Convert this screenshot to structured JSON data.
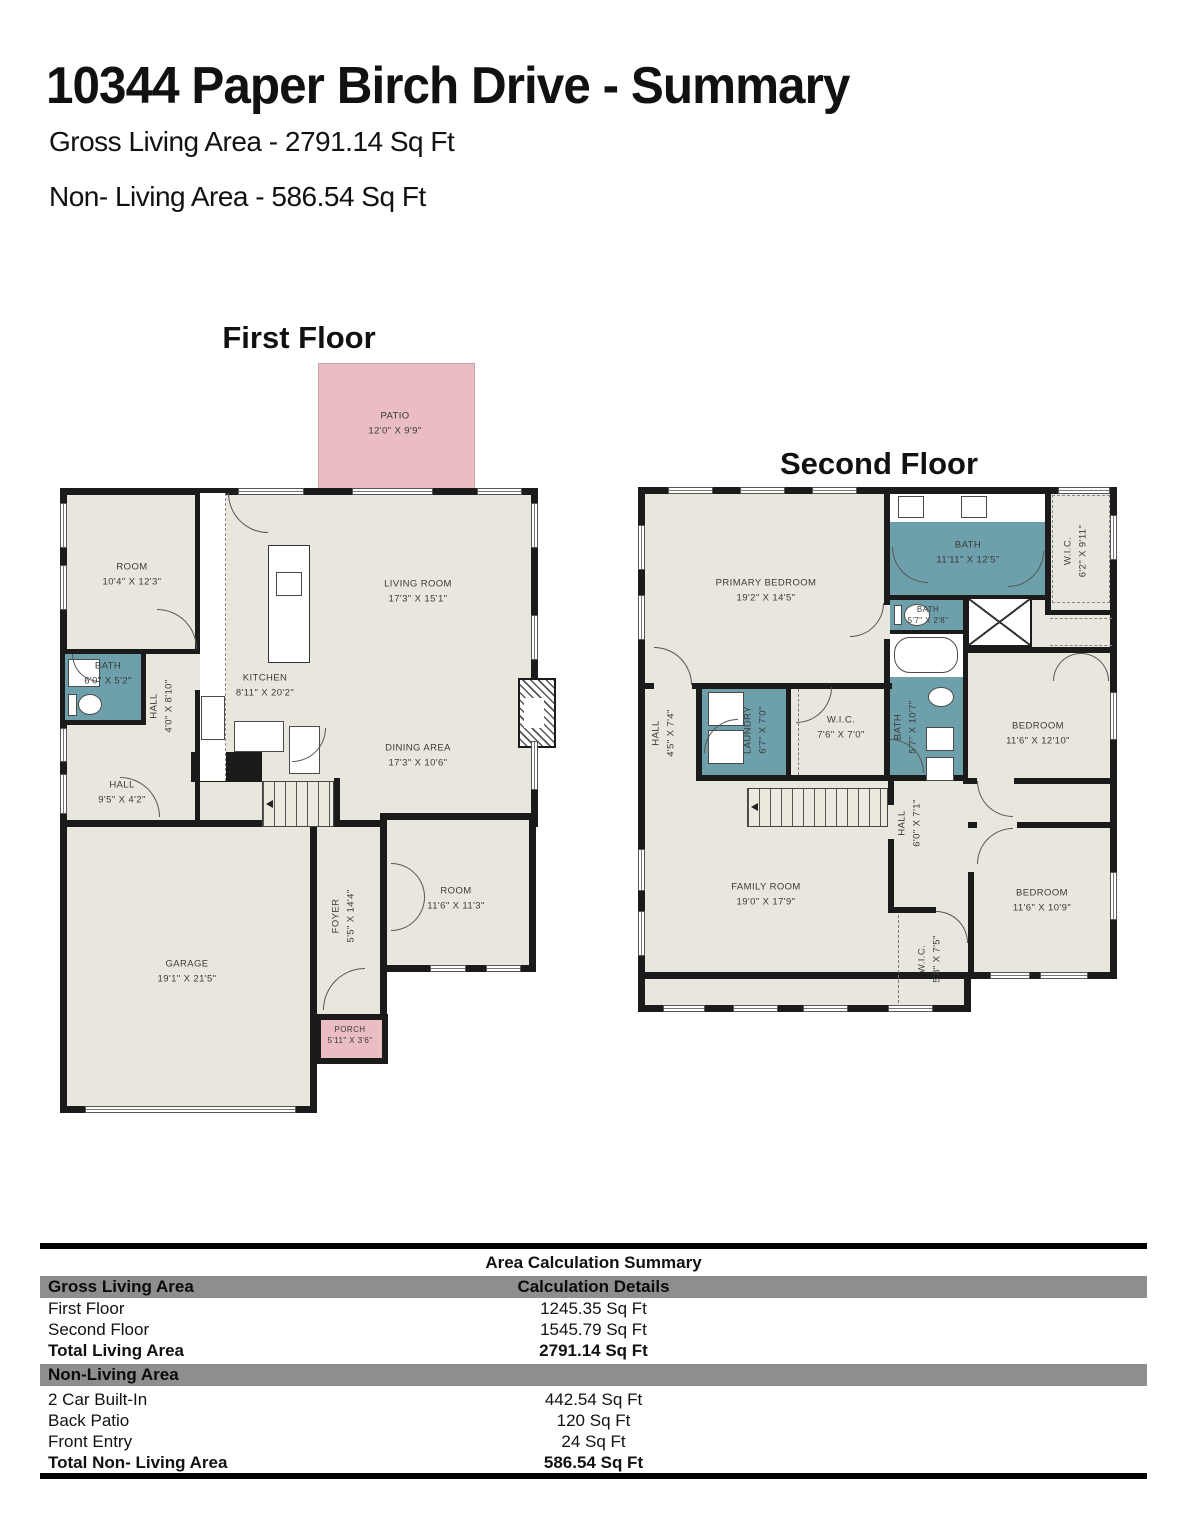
{
  "header": {
    "title": "10344 Paper Birch Drive - Summary",
    "gross_living": "Gross Living Area - 2791.14 Sq Ft",
    "non_living": "Non- Living Area - 586.54 Sq Ft"
  },
  "first_floor": {
    "label": "First Floor",
    "rooms": [
      {
        "name": "PATIO",
        "dims": "12'0\" X 9'9\""
      },
      {
        "name": "ROOM",
        "dims": "10'4\" X 12'3\""
      },
      {
        "name": "LIVING ROOM",
        "dims": "17'3\" X 15'1\""
      },
      {
        "name": "KITCHEN",
        "dims": "8'11\" X 20'2\""
      },
      {
        "name": "BATH",
        "dims": "6'0\" X 5'2\""
      },
      {
        "name": "HALL",
        "dims": "4'0\" X 8'10\""
      },
      {
        "name": "HALL",
        "dims": "9'5\" X 4'2\""
      },
      {
        "name": "DINING AREA",
        "dims": "17'3\" X 10'6\""
      },
      {
        "name": "FOYER",
        "dims": "5'5\" X 14'4\""
      },
      {
        "name": "ROOM",
        "dims": "11'6\" X 11'3\""
      },
      {
        "name": "GARAGE",
        "dims": "19'1\" X 21'5\""
      },
      {
        "name": "PORCH",
        "dims": "5'11\" X 3'6\""
      }
    ]
  },
  "second_floor": {
    "label": "Second Floor",
    "rooms": [
      {
        "name": "PRIMARY BEDROOM",
        "dims": "19'2\" X 14'5\""
      },
      {
        "name": "BATH",
        "dims": "11'11\" X 12'5\""
      },
      {
        "name": "W.I.C.",
        "dims": "6'2\" X 9'11\""
      },
      {
        "name": "BATH",
        "dims": "5'7\" X 2'8\""
      },
      {
        "name": "HALL",
        "dims": "4'5\" X 7'4\""
      },
      {
        "name": "LAUNDRY",
        "dims": "6'7\" X 7'0\""
      },
      {
        "name": "W.I.C.",
        "dims": "7'6\" X 7'0\""
      },
      {
        "name": "BATH",
        "dims": "5'7\" X 10'7\""
      },
      {
        "name": "BEDROOM",
        "dims": "11'6\" X 12'10\""
      },
      {
        "name": "FAMILY ROOM",
        "dims": "19'0\" X 17'9\""
      },
      {
        "name": "HALL",
        "dims": "6'0\" X 7'1\""
      },
      {
        "name": "BEDROOM",
        "dims": "11'6\" X 10'9\""
      },
      {
        "name": "W.I.C.",
        "dims": "5'8\" X 7'5\""
      }
    ]
  },
  "table": {
    "title": "Area Calculation Summary",
    "sections": [
      {
        "header": "Gross Living Area",
        "header_right": "Calculation Details",
        "rows": [
          {
            "label": "First Floor",
            "value": "1245.35 Sq Ft"
          },
          {
            "label": "Second Floor",
            "value": "1545.79 Sq Ft"
          }
        ],
        "total": {
          "label": "Total Living Area",
          "value": "2791.14 Sq Ft"
        }
      },
      {
        "header": "Non-Living Area",
        "header_right": "",
        "rows": [
          {
            "label": "2 Car Built-In",
            "value": "442.54 Sq Ft"
          },
          {
            "label": "Back Patio",
            "value": "120 Sq Ft"
          },
          {
            "label": "Front Entry",
            "value": "24 Sq Ft"
          }
        ],
        "total": {
          "label": "Total Non- Living Area",
          "value": "586.54 Sq Ft"
        }
      }
    ]
  },
  "colors": {
    "wall": "#1b1b1b",
    "floor": "#e9e7dd",
    "bath": "#6da0ab",
    "outdoor": "#e9bdc1",
    "table_band": "#8e8e8e"
  }
}
